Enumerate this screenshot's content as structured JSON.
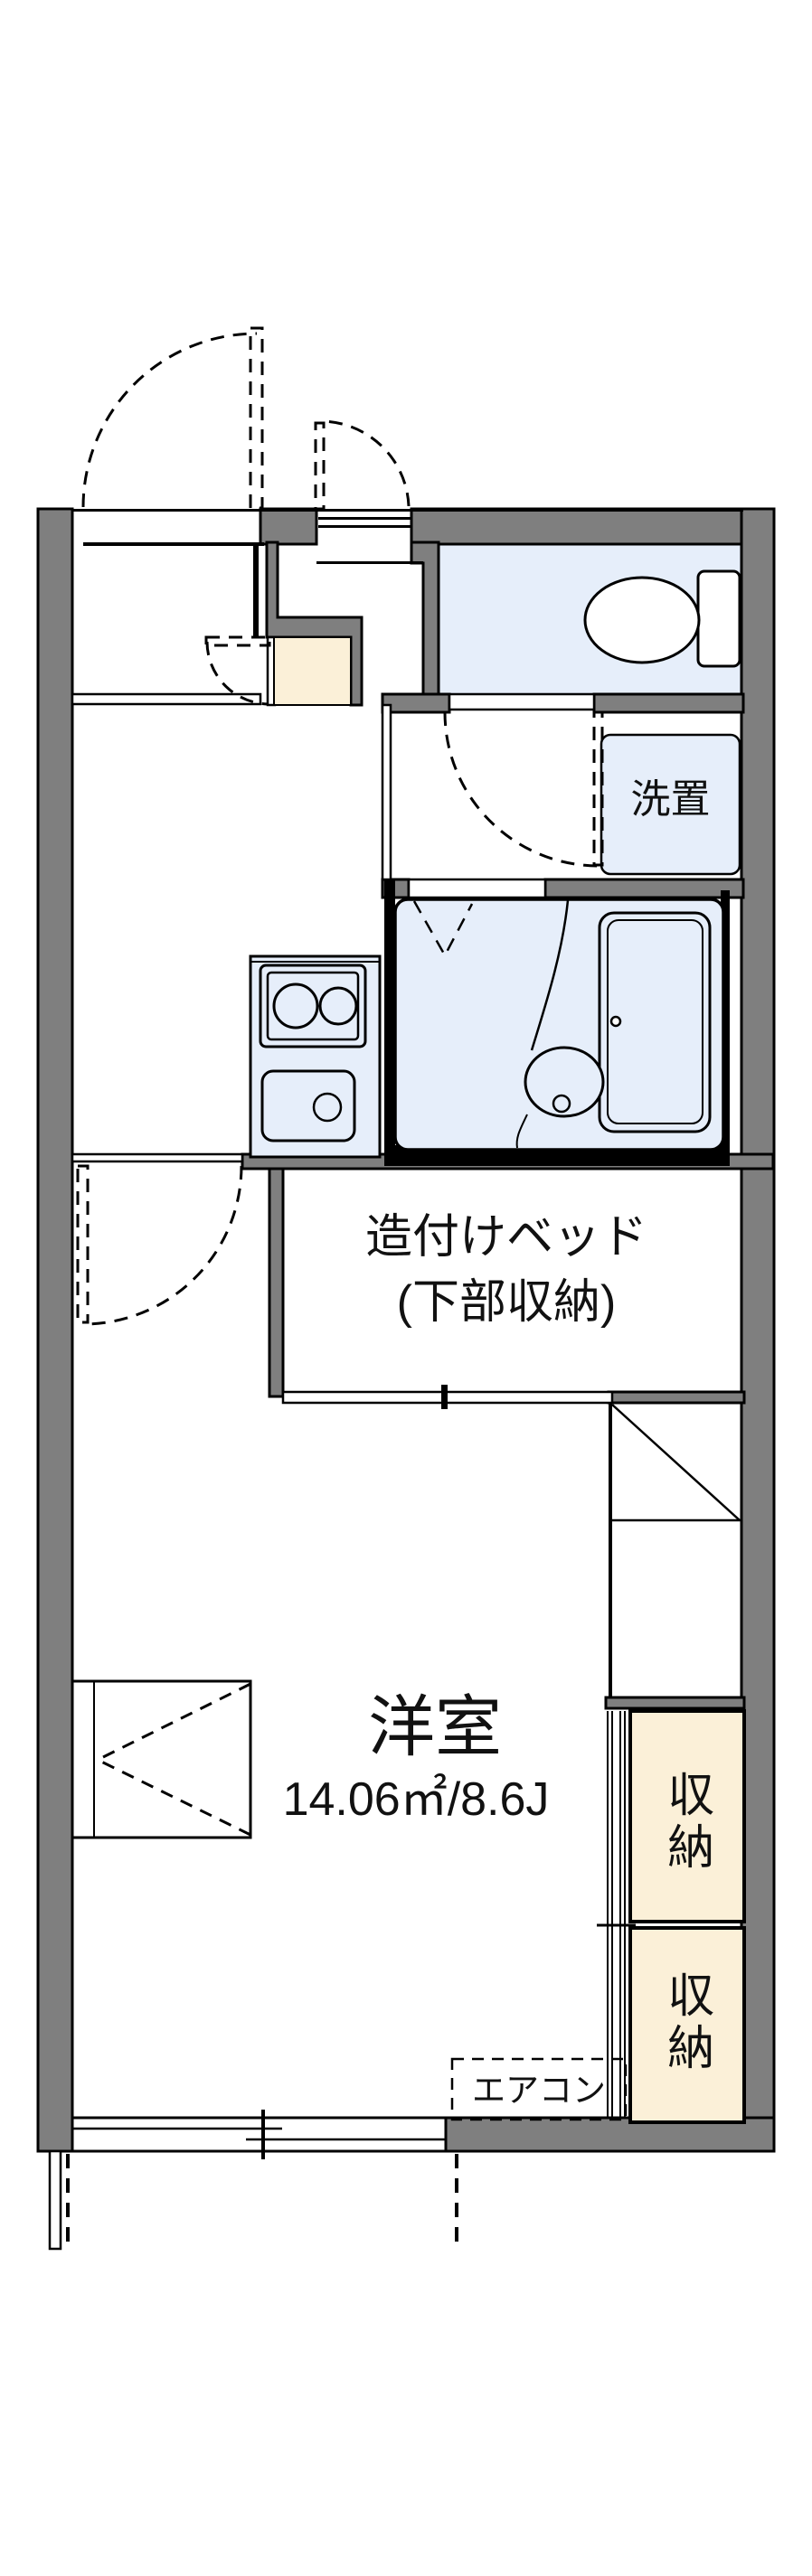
{
  "floorplan": {
    "title": "apartment-floor-plan",
    "labels": {
      "built_in_bed_line1": "造付けベッド",
      "built_in_bed_line2": "(下部収納)",
      "main_room_name": "洋室",
      "main_room_area": "14.06㎡/8.6J",
      "washer_space": "洗置",
      "storage_upper": "収納",
      "storage_lower": "収納",
      "air_conditioner": "エアコン"
    },
    "colors": {
      "wall_gray": "#7f7f7f",
      "water_area_blue": "#e6eefa",
      "storage_beige": "#fbf0d8",
      "line_black": "#000000",
      "background": "#ffffff"
    }
  }
}
